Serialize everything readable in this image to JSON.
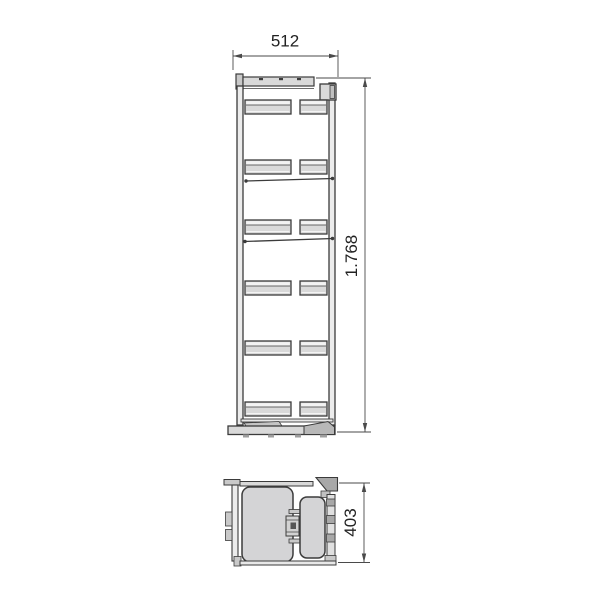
{
  "drawing": {
    "title": "pull-out column unit dimension drawing",
    "front_view": {
      "width_label": "512",
      "height_label": "1.768",
      "shelf_levels": 6,
      "shelf_rows_y": [
        100,
        160,
        220,
        281,
        341,
        402
      ]
    },
    "plan_view": {
      "depth_label": "403"
    },
    "colors": {
      "line": "#3b3b3b",
      "dimension_line": "#4a4a4a",
      "text": "#222222",
      "fill_light": "#d9d9d9",
      "fill_basket": "#d4d4d6",
      "fill_mid": "#c9c9c9",
      "fill_dark": "#a8a8a8",
      "background": "#ffffff"
    }
  }
}
